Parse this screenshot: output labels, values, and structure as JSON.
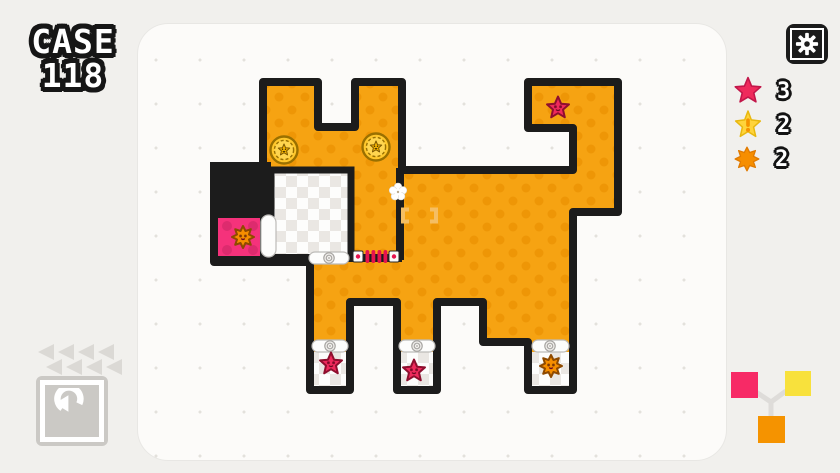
{
  "title": {
    "line1": "CASE",
    "line2": "118"
  },
  "legend": {
    "items": [
      {
        "icon": "red-star-flower-icon",
        "count": "3",
        "color": "#EF2A5C"
      },
      {
        "icon": "yellow-alert-flower-icon",
        "count": "2",
        "color": "#FFD43B"
      },
      {
        "icon": "orange-sun-flower-icon",
        "count": "2",
        "color": "#F68E00"
      }
    ]
  },
  "board": {
    "shape_label": "dog",
    "flowers": [
      {
        "type": "red-star-flower",
        "location": "tail"
      },
      {
        "type": "red-star-flower",
        "location": "front-left-leg"
      },
      {
        "type": "red-star-flower",
        "location": "front-middle-leg"
      },
      {
        "type": "orange-sun-flower",
        "location": "hind-leg"
      },
      {
        "type": "orange-sun-flower",
        "location": "pink-cell"
      }
    ],
    "badges_count": 2,
    "rollers_count": 5
  },
  "controls": {
    "undo_icon": "undo-arrow-icon",
    "rewind_arrow_count": 8,
    "settings_icon": "gear-icon"
  },
  "mix_diagram": {
    "pink": "#F72A66",
    "yellow": "#F8E13C",
    "orange": "#F59300"
  },
  "colors": {
    "page_bg": "#F1F0ED",
    "panel_bg": "#FCFBF9",
    "board_orange": "#F6A312",
    "board_orange_dot": "#EE9606",
    "wall_black": "#1C1C1C",
    "pink_cell": "#F5327B",
    "pink_cell_dot": "#DD2B6E",
    "checker_gray": "#EAE7E3",
    "star_red": "#EF2A5C",
    "star_dark": "#8E0F2E",
    "sun_orange": "#F68E00",
    "sun_dark": "#8F4A00",
    "badge_gold": "#FFC72C",
    "badge_dark": "#9A7000",
    "bracket_amber": "#F5BE63",
    "zipper_red": "#E6134E",
    "ui_gray": "#DBD9D5",
    "button_gray": "#CBC9C5",
    "legend_yellow": "#FFD43B"
  }
}
